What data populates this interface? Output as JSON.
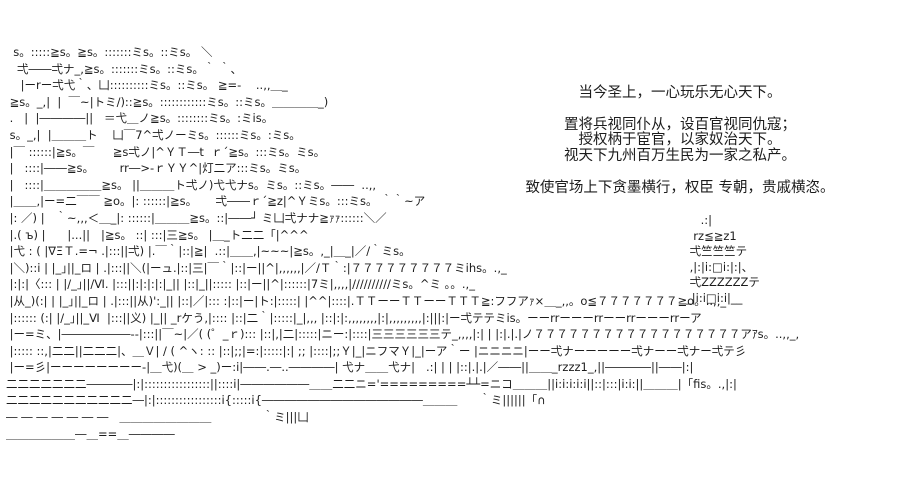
{
  "page": {
    "background_color": "#ffffff",
    "text_color": "#1c1c1c"
  },
  "dialogue": {
    "lines": [
      "当今圣上，一心玩乐无心天下。",
      "",
      "置将兵视同仆从，设百官视同仇寇；",
      "授权柄于宦官，以家奴治天下。",
      "视天下九州百万生民为一家之私产。",
      "",
      "致使官场上下贪墨横行，权臣 专朝，贵戚横恣。"
    ]
  },
  "ascii_art": {
    "description": "palace rooftop scene with pagoda tower",
    "main_lines": [
      "  s。:::::≧s。≧s。:::::::ミs。::ミs。 ＼",
      "   弌――弌ナ_,≧s。:::::::ミs。::ミs。｀ ｀、",
      "    |ーrー弌弋｀、凵::::::::::ミs。::ミs。 ≧=-    ..,,＿_",
      " ≧s。_,|  |  ￣~|トミ/)::≧s。::::::::::::ミs。::ミs。＿＿＿＿_)",
      " .   |  |――――||   ＝弋＿ノ≧s。::::::::ミs。:ミis。",
      " s。_,|  |＿＿＿ト    凵￣7^弌ノーミs。::::::ミs。:ミs。",
      " |￣ ::::::|≧s。￣     ≧s弌ノ|^ＹＴ―t  ｒ´≧s。:::ミs。ミs。",
      " |   ::::|――≧s。       rr―>-ｒＹＹ^|灯二ア:::ミs。ミs。",
      " |   ::::|＿＿＿＿＿≧s。 ||＿＿＿ト弌ノ)弋弋ナs。ミs。::ミs。――  ..,,",
      " |＿＿,|ー=二￣￣ ≧o。|: ::::::|≧s。     弌――ｒ´≧z|^Ｙミs。:::ミs。 ｀｀~ア",
      " |: ／) |   ｀~,,,＜＿_|: ::::::|＿＿＿≧s。::|――┘ ミ凵弌ナナ≧ｧｧ::::::＼／",
      " |.( ъ) |      |...||   |≧s。 ::| :::|三≧s。 |＿_ト二二「|^^^",
      " |弋 : ( |∇ΞＴ.=¬ .|:::||弌) |.￣｀|::|≧|  .::|＿＿,|~~~|≧s。,_|＿_|／/｀ミs。",
      " |＼)::i | |_｣||_ロ | .|:::||＼(|ーュ.|::|三|￣｀|::|ー||^|,,,,,,|／/Ｔ｀:|７７７７７７７７７ミihs。.,_",
      " |:|:|〈::: | |/_｣||/Ⅵ. |:::||:|:|:|:|_|| |::|_||::::: |::|ー||^|::::::|7ミ|,,,,|//////////ミs。^ミ ｡。.,_",
      " |从_)(:| | |_｣||_ロ | .|:::||从)':_|| |::|／|::: :|::|ー|ト:|:::::| |^^|::::|.ＴＴーーＴＴーーＴＴＴ≧:フフアｧ×＿_,,。o≦７７７７７７７≧o。..,,_",
      " |:::::: (:| |/_｣||_Ⅵ  |:::||义) |_|| _rケう,|:::: |::|二｀|:::::|_|,,, |::|:|:,,,,,,,,|:|,,,,,,,,,|:|||:|ー弌テテミis。ーーrrーーーrrーーrrーーーrrーア",
      " |ー=ミ、|――――――--|:::||￣~|／( (゜_ｒ)::: |::|,|二|:::::|ニー:|::::|三三三三三三テ_,,,,|:| | |:|.|.|ノ７７７７７７７７７７７７７７７７７７アｱs。..,,_,",
      " |::::: ::,|二二||二二二|、＿Ｖ| / ( ^ヽ: :: |::|;;|=:|:::::|:| ;; |::::|;;Ｙ|_|ニフマＹ|_|ーア｀ー |ニニニニ|ーー弌ナーーーーー弌ナーー弌ナー弌テ彡",
      " |ー=彡|ーーーーーーーー-|＿弋)(＿ > _)ー:i|――.―..――――| 弋ナ＿＿弋ナ|   .:| | | |::|.|.|／――||＿＿_rzzz1_,||――――||――|:|",
      "二二二二二二二――――|:|:::::::::::::::::||::::i|――――――＿＿二二ニ='=========┴┴=ニコ＿＿＿||i:i:i:i:i||::|:::|i:i:||＿＿＿|「fis。.,|:|",
      "二二二二二二二二二二二―|:|:::::::::::::::::i{:::::i{――――――――――――――＿＿＿      ｀ミ||||||「∩",
      "― ― ― ― ― ― ―   ＿＿＿＿＿＿＿＿              ｀ミ|||凵",
      "＿＿＿＿＿＿―＿==＿――――",
      ""
    ],
    "pagoda_lines": [
      "    .:|",
      "  rz≦≧z1",
      " 弌竺竺竺テ",
      " ,|:|i:□i:|:|、",
      " 弌ZZZZZZテ",
      "_|i:i□i:i|__"
    ]
  }
}
